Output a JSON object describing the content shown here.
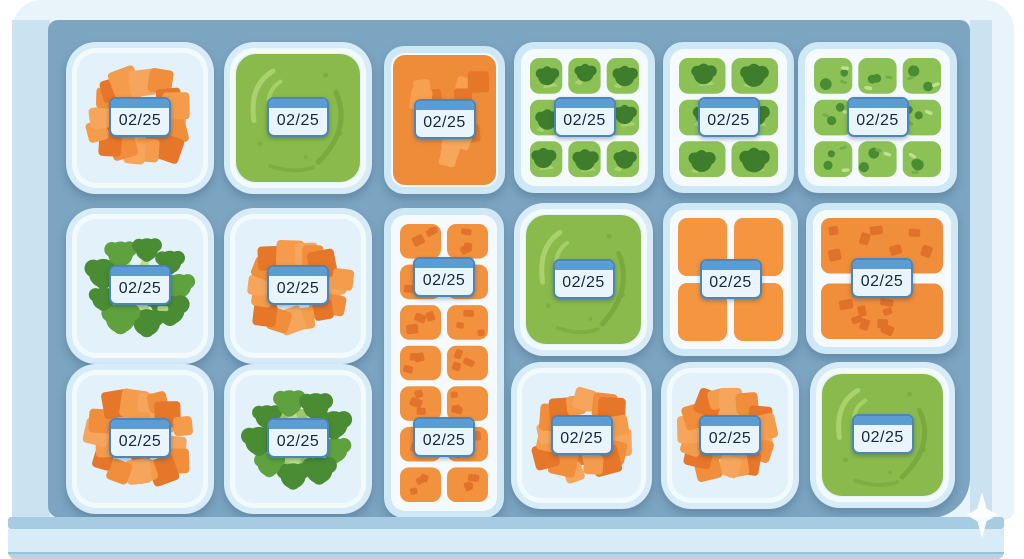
{
  "scene": {
    "date_label": "02/25",
    "watermark_icon": "sparkle-4-point-star"
  },
  "colors": {
    "freezer_frame": "#e8f3fa",
    "drawer_wall": "#cbe2f1",
    "drawer_interior": "#7ca5c2",
    "drawer_front": "#d7ecf7",
    "container_rim": "#d7ebf8",
    "container_white": "#f2fafd",
    "container_inner": "#e3f1fb",
    "label_body": "#e9f4fc",
    "label_bar": "#5d9cd3",
    "label_text": "#15293c",
    "orange": "#f08e3c",
    "orange_light": "#f6a65c",
    "orange_dark": "#e5762a",
    "green_cell": "#8cc156",
    "green_puree": "#8aba4b",
    "broccoli_dark": "#4a8c33"
  },
  "containers": [
    {
      "id": "r1c1",
      "row": 1,
      "col": 1,
      "contents": "orange-veggie-cubes-pile",
      "label": "02/25"
    },
    {
      "id": "r1c2",
      "row": 1,
      "col": 2,
      "contents": "green-puree",
      "label": "02/25"
    },
    {
      "id": "r1c3",
      "row": 1,
      "col": 3,
      "contents": "orange-cubes-packed",
      "label": "02/25"
    },
    {
      "id": "r1c4",
      "row": 1,
      "col": 4,
      "contents": "broccoli-cube-tray-3x3",
      "label": "02/25"
    },
    {
      "id": "r1c5",
      "row": 1,
      "col": 5,
      "contents": "broccoli-cube-tray-2x3",
      "label": "02/25"
    },
    {
      "id": "r1c6",
      "row": 1,
      "col": 6,
      "contents": "mixed-veg-cube-tray-3x3",
      "label": "02/25"
    },
    {
      "id": "r2c1",
      "row": 2,
      "col": 1,
      "contents": "broccoli-florets",
      "label": "02/25"
    },
    {
      "id": "r2c2",
      "row": 2,
      "col": 2,
      "contents": "orange-veggie-cubes-pile",
      "label": "02/25"
    },
    {
      "id": "r2c3",
      "row": 2,
      "col": 3,
      "contents": "orange-cube-tray-2x7-tall",
      "labels": [
        "02/25",
        "02/25"
      ]
    },
    {
      "id": "r2c4",
      "row": 2,
      "col": 4,
      "contents": "green-puree",
      "label": "02/25"
    },
    {
      "id": "r2c5",
      "row": 2,
      "col": 5,
      "contents": "orange-portions-2x2",
      "label": "02/25"
    },
    {
      "id": "r2c6",
      "row": 2,
      "col": 6,
      "contents": "orange-slabs-with-chunks",
      "label": "02/25"
    },
    {
      "id": "r3c1",
      "row": 3,
      "col": 1,
      "contents": "orange-veggie-cubes-pile",
      "label": "02/25"
    },
    {
      "id": "r3c2",
      "row": 3,
      "col": 2,
      "contents": "broccoli-florets-ring",
      "label": "02/25"
    },
    {
      "id": "r3c4",
      "row": 3,
      "col": 4,
      "contents": "orange-veggie-cubes-pile",
      "label": "02/25"
    },
    {
      "id": "r3c5",
      "row": 3,
      "col": 5,
      "contents": "orange-veggie-cubes-pile",
      "label": "02/25"
    },
    {
      "id": "r3c6",
      "row": 3,
      "col": 6,
      "contents": "green-puree",
      "label": "02/25"
    }
  ]
}
